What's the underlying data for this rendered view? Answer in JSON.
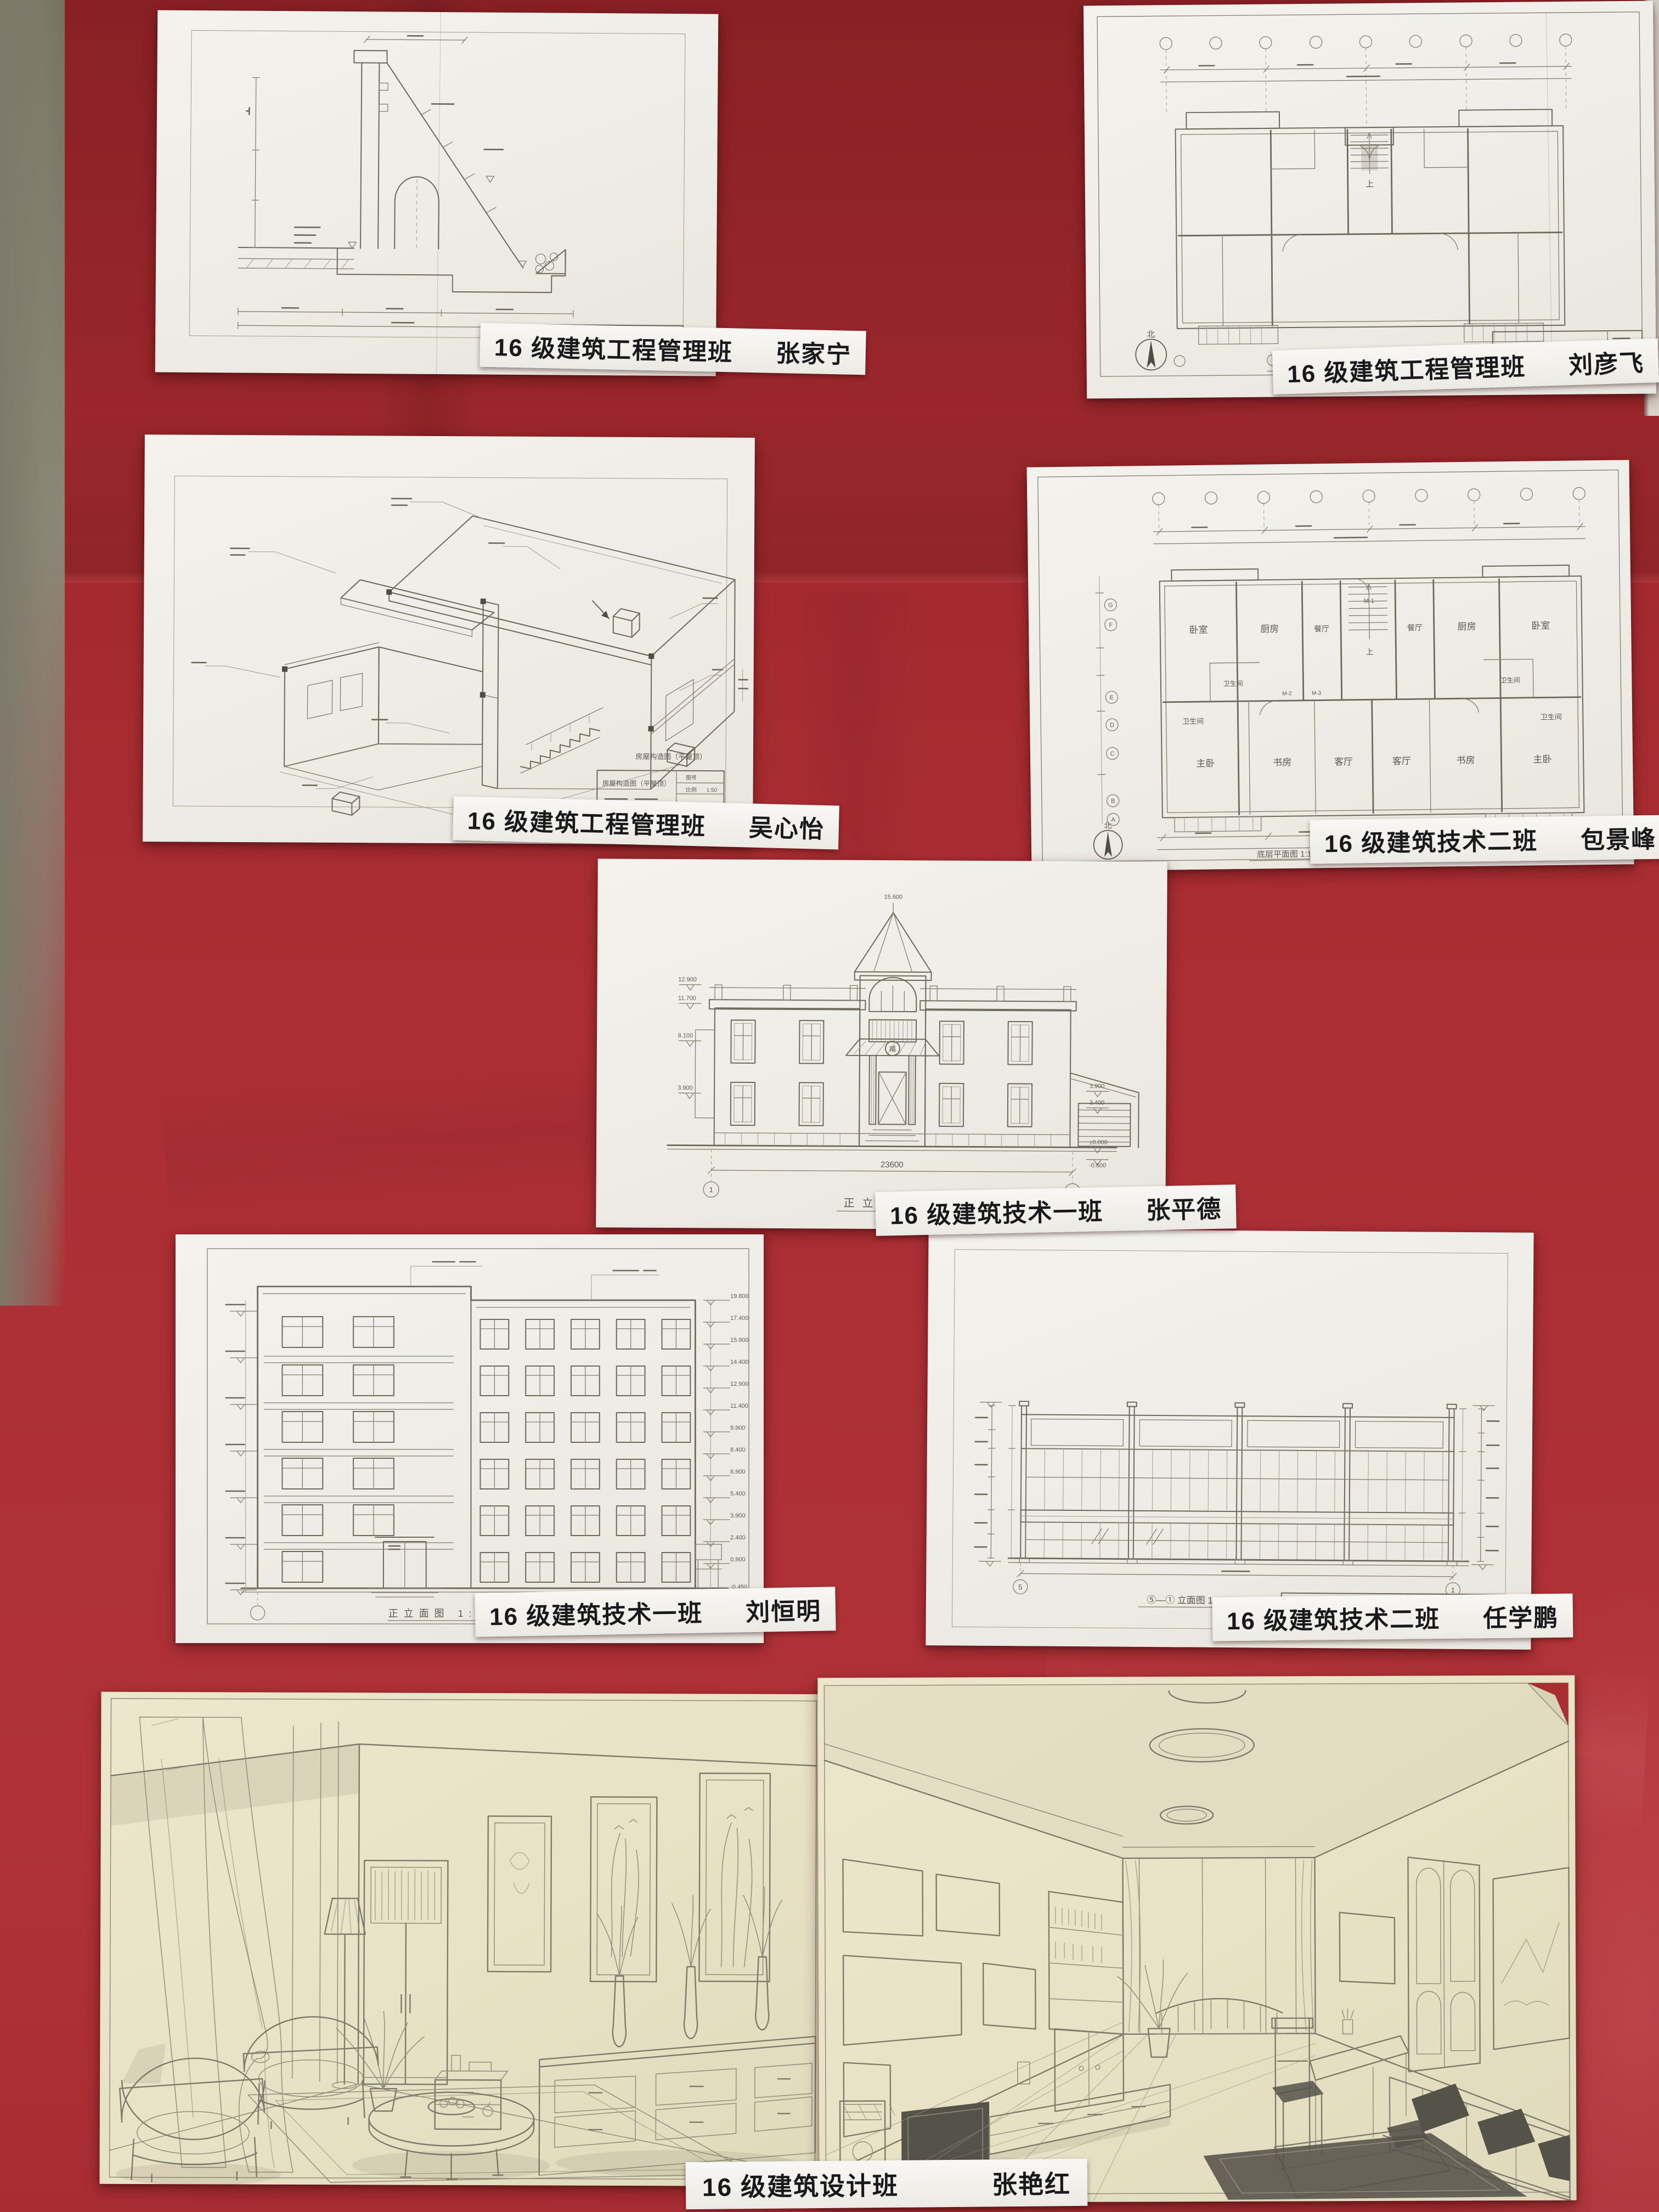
{
  "board": {
    "description": "red fabric display board with pinned student architectural drawings",
    "fabric_color": "#a92d32",
    "fabric_color_dark": "#97242a",
    "fabric_color_light": "#b8474c",
    "left_wall_color": "#7d7a6b",
    "right_wall_color": "#d8d4cb",
    "paper_white": "#f2efe9",
    "paper_cream": "#e9e3c8",
    "pencil_color": "#6e695d"
  },
  "papers": [
    {
      "name": "retaining-wall-section",
      "class_label": "16 级建筑工程管理班",
      "student": "张家宁"
    },
    {
      "name": "floor-plan-liu",
      "class_label": "16 级建筑工程管理班",
      "student": "刘彦飞",
      "title_block": "底层平面图",
      "caption": "底层平面图",
      "north": "北",
      "stair_label": "上"
    },
    {
      "name": "axonometric-construction",
      "class_label": "16 级建筑工程管理班",
      "student": "吴心怡",
      "title_block": "房屋构造图（平屋顶）",
      "annotation": "房屋构造图（平屋顶）",
      "sheet_no_label": "图号",
      "scale_label": "比例",
      "scale": "1:50"
    },
    {
      "name": "floor-plan-bao",
      "class_label": "16 级建筑技术二班",
      "student": "包景峰",
      "title_block": "底层平面图",
      "caption": "底层平面图 1:100",
      "north": "北",
      "stair_label": "上",
      "total_width": "23640",
      "sheet_no_label": "图号",
      "sheet_no": "A3",
      "scale_label": "比例",
      "scale": "1:100",
      "rooms": [
        "卧室",
        "厨房",
        "餐厅",
        "卫生间",
        "主卧",
        "书房",
        "客厅"
      ],
      "door_labels": [
        "M-1",
        "M-2",
        "M-3"
      ],
      "axis_letters": [
        "A",
        "B",
        "C",
        "D",
        "E",
        "F",
        "G"
      ]
    },
    {
      "name": "villa-elevation",
      "class_label": "16 级建筑技术一班",
      "student": "张平德",
      "caption": "正立面图",
      "title_block": "正立面图",
      "scale": "1:100",
      "total_width": "23600",
      "axis_start": "1",
      "axis_end": "7",
      "spire_height": "15.600",
      "medallion": "福",
      "elev_left": [
        "12.900",
        "11.700",
        "8.100",
        "3.900"
      ],
      "elev_right": [
        "3.900",
        "3.400",
        "±0.000",
        "-0.600"
      ],
      "sheet_no_label": "图号",
      "sheet_no": "1",
      "scale_label": "比例"
    },
    {
      "name": "six-storey-elevation",
      "class_label": "16 级建筑技术一班",
      "student": "刘恒明",
      "caption": "正立面图 1:100",
      "title_block": "正立面图",
      "sheet_no_label": "图号",
      "sheet_no": "1",
      "scale_label": "比例",
      "scale": "1:100",
      "elevations": [
        "19.800",
        "17.400",
        "15.900",
        "14.400",
        "12.900",
        "11.400",
        "9.900",
        "8.400",
        "6.900",
        "5.400",
        "3.900",
        "2.400",
        "0.900",
        "-0.450"
      ]
    },
    {
      "name": "storefront-elevation",
      "class_label": "16 级建筑技术二班",
      "student": "任学鹏",
      "caption": "⑤—① 立面图 1:100",
      "title_block": "⑤—① 立面图",
      "sheet_no_label": "图号",
      "sheet_no": "建施-6",
      "scale_label": "比例",
      "scale": "1:100",
      "axis_start": "5",
      "axis_end": "1"
    },
    {
      "name": "interior-perspectives",
      "class_label": "16 级建筑设计班",
      "student": "张艳红"
    }
  ]
}
